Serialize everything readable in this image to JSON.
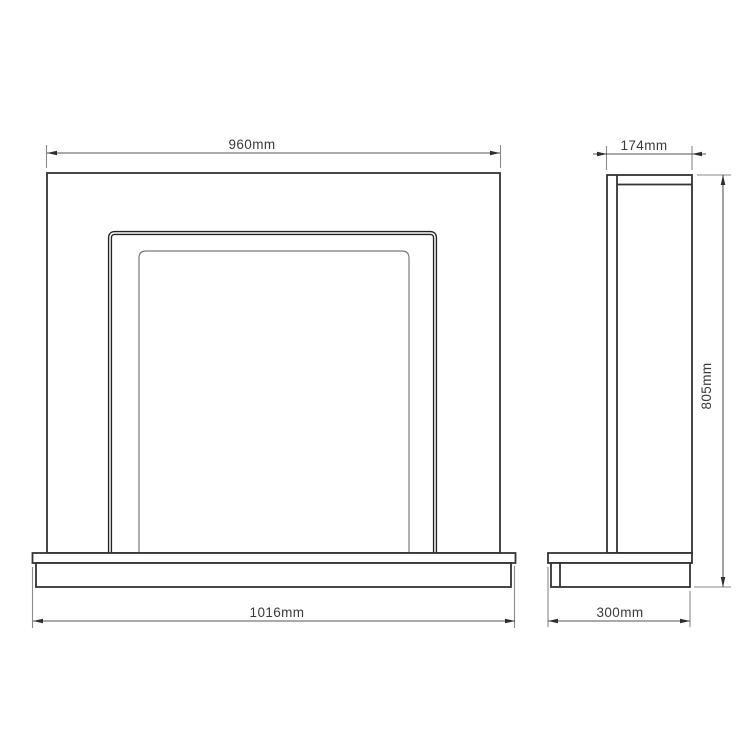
{
  "drawing": {
    "background_color": "#ffffff",
    "line_color": "#333333",
    "light_line_color": "#7a7a7a",
    "dimension_line_color": "#555555",
    "dimensions": {
      "front_top_width": "960mm",
      "front_base_width": "1016mm",
      "side_top_depth": "174mm",
      "side_height": "805mm",
      "side_base_depth": "300mm"
    }
  }
}
